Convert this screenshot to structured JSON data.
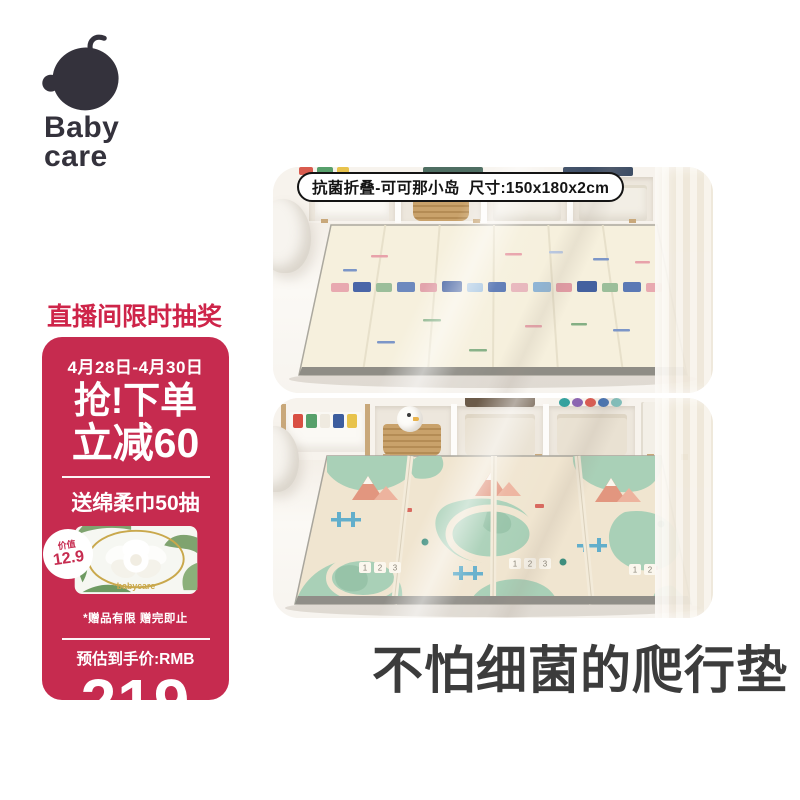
{
  "logo": {
    "line1": "Baby",
    "line2": "care"
  },
  "top_photo": {
    "label": "抗菌折叠-可可那小岛  尺寸:150x180x2cm"
  },
  "promo": {
    "header": "直播间限时抽奖",
    "dates": "4月28日-4月30日",
    "hook": "抢!下单",
    "discount": "立减60",
    "gift": "送绵柔巾50抽",
    "badge_label": "价值",
    "badge_value": "12.9",
    "note": "*赠品有限 赠完即止",
    "price_label": "预估到手价:RMB",
    "price": "219"
  },
  "headline": "不怕细菌的爬行垫",
  "decor": {
    "wipes_brand": "babycare",
    "mat_numbers": [
      "1",
      "2",
      "3"
    ]
  },
  "colors": {
    "promo_red": "#C62B4F",
    "header_red": "#CE2449",
    "headline_gray": "#3C3C3C",
    "logo_charcoal": "#34323C",
    "mat_cream": "#F6F0DD",
    "mat_green": "#A9D0B7"
  }
}
